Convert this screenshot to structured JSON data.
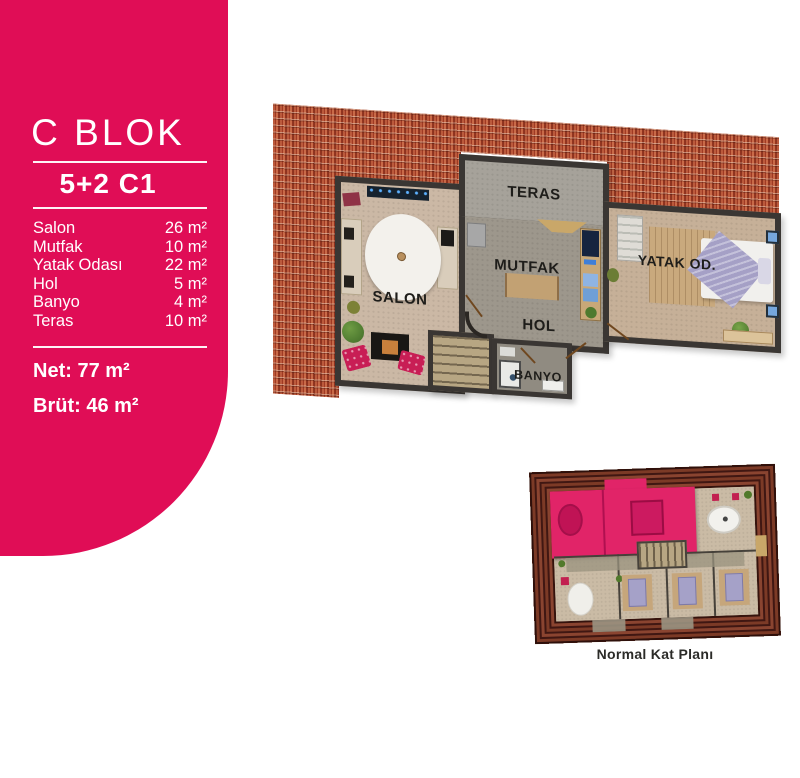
{
  "info_card": {
    "accent_color": "#e00d56",
    "block_title": "C BLOK",
    "unit_code": "5+2 C1",
    "rooms": [
      {
        "name": "Salon",
        "area": "26 m²"
      },
      {
        "name": "Mutfak",
        "area": "10 m²"
      },
      {
        "name": "Yatak Odası",
        "area": "22 m²"
      },
      {
        "name": "Hol",
        "area": "5 m²"
      },
      {
        "name": "Banyo",
        "area": "4 m²"
      },
      {
        "name": "Teras",
        "area": "10 m²"
      }
    ],
    "net_area": "Net: 77 m²",
    "brut_area": "Brüt: 46 m²"
  },
  "floor_plan": {
    "roof_color": "#a84630",
    "wall_color": "#3a3633",
    "room_labels": {
      "salon": "SALON",
      "teras": "TERAS",
      "mutfak": "MUTFAK",
      "hol": "HOL",
      "banyo": "BANYO",
      "yatak_odasi": "YATAK OD."
    }
  },
  "mini_plan": {
    "caption": "Normal Kat Planı",
    "highlight_color": "#e12468"
  }
}
